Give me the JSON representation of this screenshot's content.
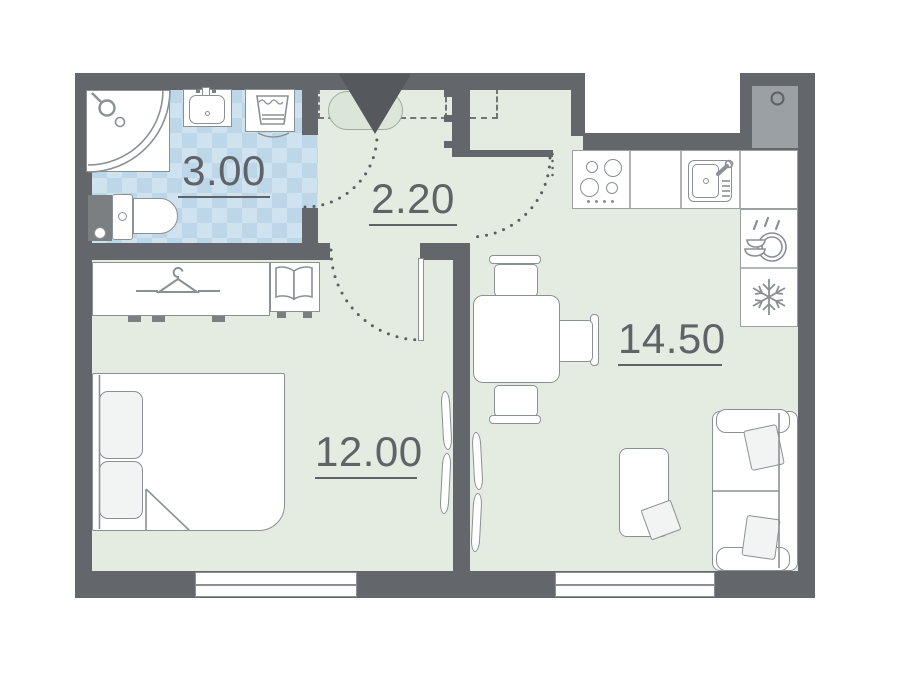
{
  "plan": {
    "title": "apartment-floor-plan",
    "rooms": [
      {
        "name": "bathroom",
        "area": "3.00"
      },
      {
        "name": "hallway",
        "area": "2.20"
      },
      {
        "name": "bedroom",
        "area": "12.00"
      },
      {
        "name": "living-kitchen",
        "area": "14.50"
      }
    ],
    "fixtures": [
      "entrance-door",
      "shower",
      "washbasin",
      "washing-machine",
      "toilet",
      "wardrobe",
      "nightstand",
      "double-bed",
      "interior-door",
      "radiator",
      "dining-table",
      "chair",
      "stove",
      "kitchen-sink",
      "dishwasher",
      "refrigerator",
      "sofa",
      "coffee-table",
      "window",
      "ventilation-shaft"
    ],
    "colors": {
      "wall": "#63666a",
      "entrance_marker": "#55585c",
      "floor": "#e4ece2",
      "bathroom_tile": "#cfe2f0",
      "bathroom_tile_check": "#bdd7e9",
      "fixture_outline": "#8b9094",
      "label_text": "#5f6367",
      "shaft_fill": "#9aa0a3"
    }
  }
}
